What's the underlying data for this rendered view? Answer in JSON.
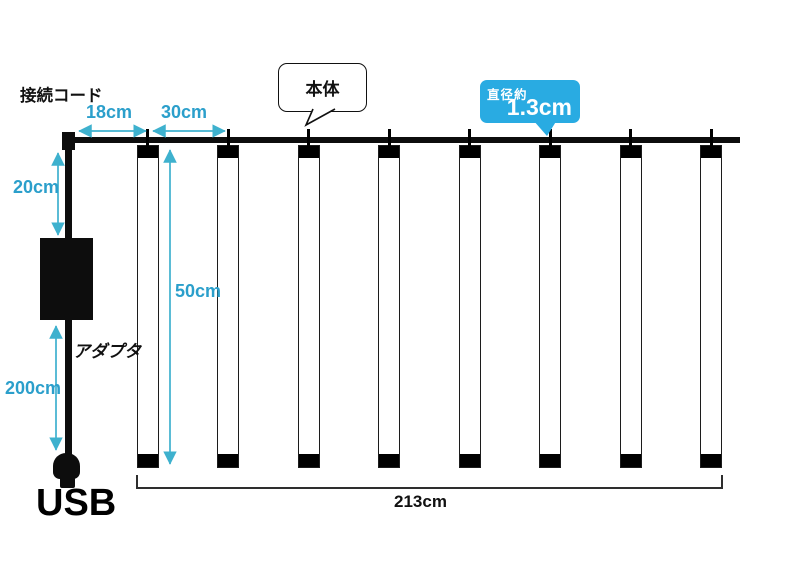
{
  "diagram": {
    "labels": {
      "connection_cord": "接続コード",
      "main_body": "本体",
      "adapter": "アダプタ",
      "usb_plug": "USB"
    },
    "dimensions": {
      "cord_to_first_tube": "18cm",
      "tube_spacing": "30cm",
      "cord_drop": "20cm",
      "tube_length": "50cm",
      "usb_cable_length": "200cm",
      "total_width": "213cm",
      "diameter_prefix": "直径約",
      "diameter_value": "1.3cm"
    },
    "tube_count": 8,
    "colors": {
      "accent_blue": "#29ABE2",
      "dimension_text_blue": "#2B9FCB",
      "arrow_blue": "#3EB1CE",
      "hardware_black": "#0D0D0D"
    }
  }
}
